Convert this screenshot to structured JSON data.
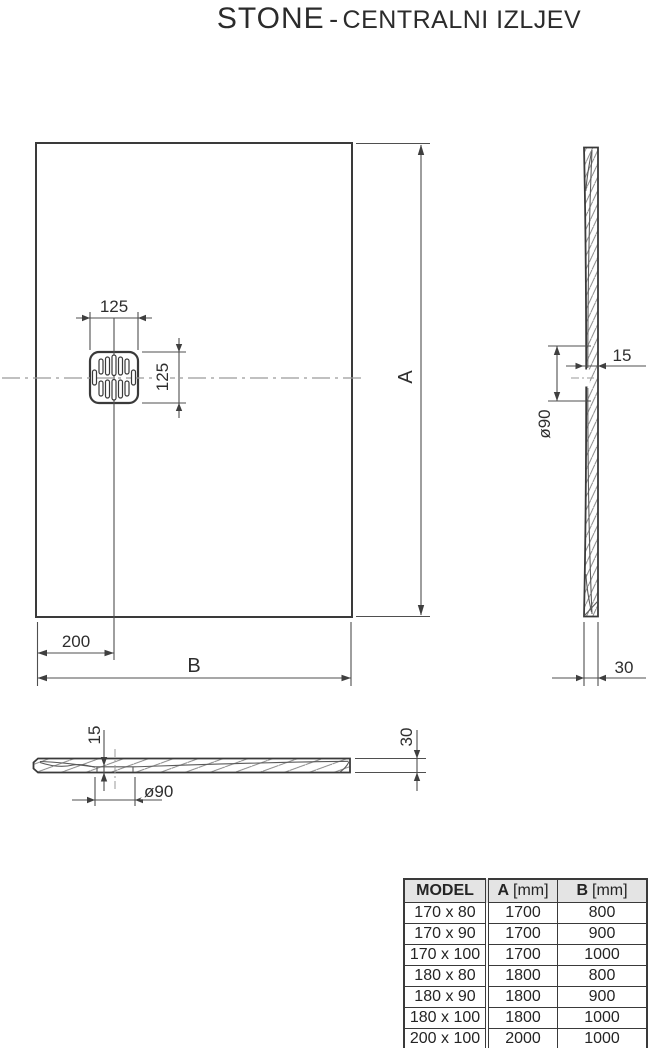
{
  "title": {
    "product": "STONE",
    "separator": "-",
    "variant": "CENTRALNI IZLJEV"
  },
  "dimensions": {
    "plan": {
      "drain_width": "125",
      "drain_height": "125",
      "drain_offset_left": "200",
      "length_label": "A",
      "width_label": "B"
    },
    "side": {
      "thickness_at_drain": "15",
      "drain_diameter": "ø90",
      "edge_thickness": "30"
    },
    "front": {
      "thickness_at_drain": "15",
      "drain_diameter": "ø90",
      "edge_thickness": "30"
    }
  },
  "table": {
    "headers": {
      "model": "MODEL",
      "a_label": "A",
      "a_unit": "[mm]",
      "b_label": "B",
      "b_unit": "[mm]"
    },
    "rows": [
      [
        "170 x 80",
        "1700",
        "800"
      ],
      [
        "170 x 90",
        "1700",
        "900"
      ],
      [
        "170 x 100",
        "1700",
        "1000"
      ],
      [
        "180 x 80",
        "1800",
        "800"
      ],
      [
        "180 x 90",
        "1800",
        "900"
      ],
      [
        "180 x 100",
        "1800",
        "1000"
      ],
      [
        "200 x 100",
        "2000",
        "1000"
      ]
    ]
  },
  "colors": {
    "drawing_line": "#3a3a3a",
    "dimension_line": "#4f4f4f",
    "centerline": "#9a9a9a",
    "table_header_bg": "#e4e4e4",
    "text": "#2b2b2b"
  }
}
